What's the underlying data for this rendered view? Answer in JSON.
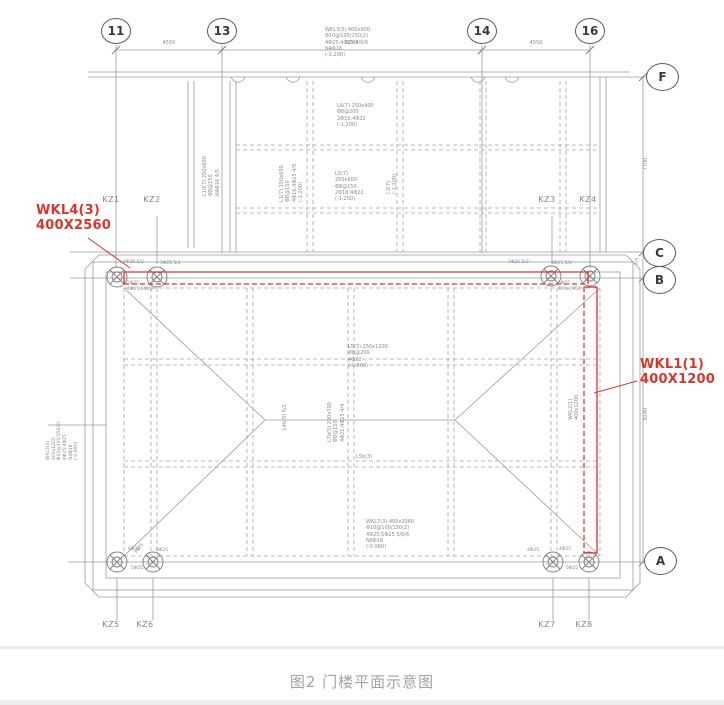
{
  "caption": "图2 门楼平面示意图",
  "bubbles": {
    "b11": "11",
    "b13": "13",
    "b14": "14",
    "b16": "16",
    "f": "F",
    "c": "C",
    "b": "B",
    "a": "A"
  },
  "dims": {
    "top1": "4550",
    "top2": "9240",
    "top3": "4550",
    "right_top": "7700",
    "right_bottom": "9240",
    "right_small": "775"
  },
  "columns": {
    "kz1": "KZ1",
    "kz2": "KZ2",
    "kz3": "KZ3",
    "kz4": "KZ4",
    "kz5": "KZ5",
    "kz6": "KZ6",
    "kz7": "KZ7",
    "kz8": "KZ8"
  },
  "red": {
    "color": "#d9362b",
    "top_label": "WKL4(3)\n400X2560",
    "right_label": "WKL1(1)\n400X1200"
  },
  "notes": {
    "top": "WKL3(3) 400x900\nΦ10@100/150(2)\n4Φ25;4Φ25 4/6/6\nN4Φ16\n(-2.200)",
    "u1": "L6(7) 250x400\nΦ8@200\n2Φ16;4Φ22\n(-1.200)",
    "u2": "L5(7)\n250x600\nΦ8@150\n2Φ16;4Φ22\n(-1.200)",
    "u3": "L1(7) 250x600\nΦ8@150\n4Φ16;4Φ25 4/5\n(-1.200)",
    "u4": "L10(7) 250x600\nΦ8@150\nN4Φ16 4/5",
    "u5": "L3(7)\n(-1.200)",
    "left": "WKL5(3) 400x1200\nΦ10@100/150(2)\n4Φ25;4Φ25\nN4Φ16\n(-0.060)",
    "center": "L5(3) 250x1200\nΦ8@200\n4Φ22\n(-0.060)",
    "center_rot": "L7b(5) 200x700\nΦ8@150\n4Φ22;4Φ25 4/4",
    "center_rot2": "L4b(5) 5/2",
    "center_small": "L5b(3)",
    "bottom": "WKL7(3) 400x2060\nΦ10@100/150(2)\n4Φ25;5Φ25 3/6/6\nN6Φ16\n(-0.060)",
    "right_inner": "WKL2(1)\n400x1200"
  },
  "marks": {
    "m1": "4Φ25 5/2",
    "m2": "3Φ25 5/2",
    "m3": "7Φ25 5/2",
    "m4": "3Φ25 5/2",
    "below_left": "5Φ25\n4Φ25;3Φ20",
    "below_right": "5Φ25\n400x1950",
    "bl1": "6Φ25",
    "bl2": "6Φ25",
    "bl3": "5Φ25",
    "bl4": "3Φ25",
    "br1": "4Φ25",
    "br2": "4Φ25",
    "br3": "5Φ25"
  }
}
